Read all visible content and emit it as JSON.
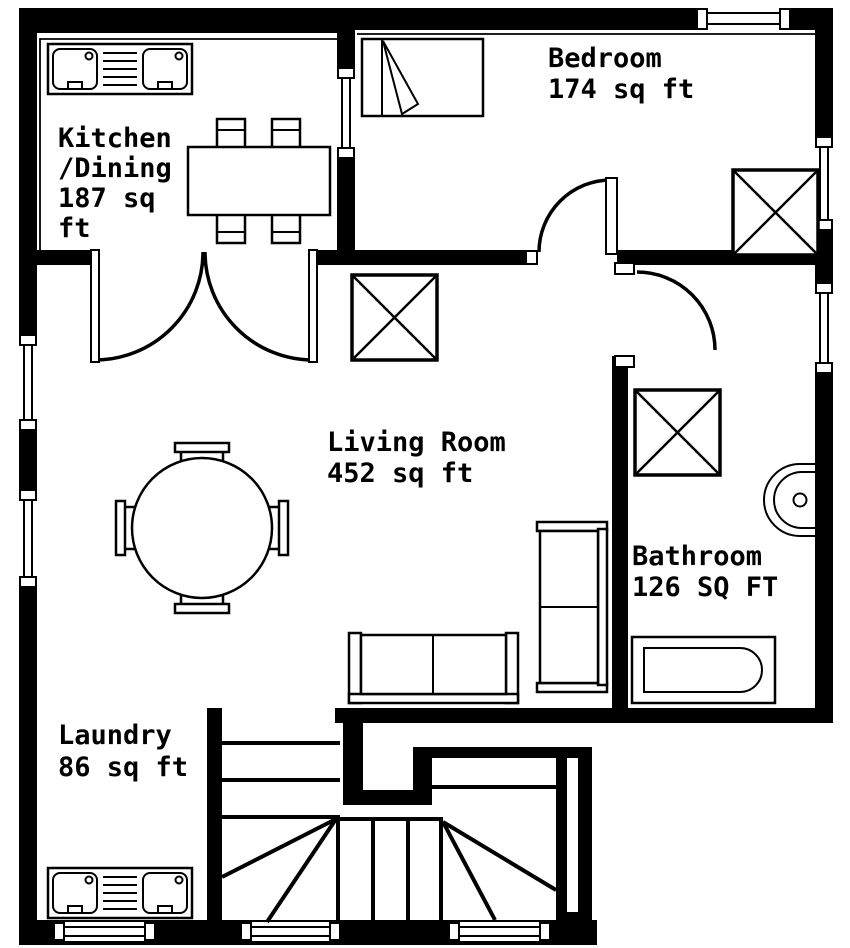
{
  "title": "Apartment floor plan",
  "colors": {
    "wall": "#000000",
    "background": "#ffffff",
    "line": "#000000"
  },
  "rooms": {
    "kitchen": {
      "name": "Kitchen/Dining",
      "area": "187 sq ft",
      "label_lines": [
        "Kitchen",
        "/Dining",
        "187 sq",
        "ft"
      ]
    },
    "bedroom": {
      "name": "Bedroom",
      "area": "174 sq ft",
      "label_lines": [
        "Bedroom",
        "174 sq ft"
      ]
    },
    "living": {
      "name": "Living Room",
      "area": "452 sq ft",
      "label_lines": [
        "Living Room",
        "452 sq ft"
      ]
    },
    "bathroom": {
      "name": "Bathroom",
      "area": "126 SQ FT",
      "label_lines": [
        "Bathroom",
        "126 SQ FT"
      ]
    },
    "laundry": {
      "name": "Laundry",
      "area": "86 sq ft",
      "label_lines": [
        "Laundry",
        "86 sq ft"
      ]
    }
  },
  "fixtures": [
    "kitchen-sink-unit",
    "dining-table",
    "dining-chairs",
    "bed",
    "bedroom-crossed-box",
    "living-crossed-box",
    "round-table",
    "round-table-chairs",
    "sofa-horizontal",
    "sofa-vertical",
    "bathroom-crossed-box",
    "bathroom-basin",
    "bathtub",
    "laundry-sink-unit",
    "staircase"
  ],
  "doors": [
    "kitchen-double-door",
    "bedroom-door",
    "bathroom-door"
  ],
  "window_count": 9
}
